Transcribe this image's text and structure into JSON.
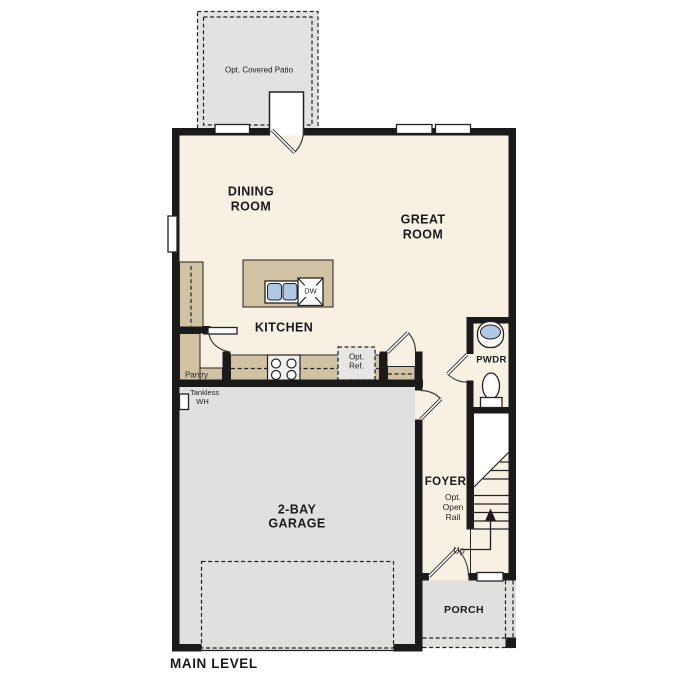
{
  "title": "MAIN LEVEL",
  "colors": {
    "wall": "#1a1a1a",
    "floor": "#f8f0e2",
    "patio": "#e2e2e0",
    "garage": "#e0e0de",
    "counter": "#d2c2a4",
    "sink": "#b0c8e4",
    "optref": "#e6e6e4"
  },
  "rooms": {
    "patio": {
      "label": "Opt. Covered Patio"
    },
    "dining": {
      "label": "DINING\nROOM"
    },
    "great": {
      "label": "GREAT\nROOM"
    },
    "kitchen": {
      "label": "KITCHEN"
    },
    "pantry": {
      "label": "Pantry"
    },
    "pwdr": {
      "label": "PWDR"
    },
    "foyer": {
      "label": "FOYER"
    },
    "garage": {
      "label": "2-BAY\nGARAGE"
    },
    "porch": {
      "label": "PORCH"
    }
  },
  "annotations": {
    "dishwasher": "DW",
    "opt_ref": "Opt.\nRef.",
    "tankless": "Tankless\n   WH",
    "open_rail": "Opt.\nOpen\nRail",
    "up": "Up"
  },
  "footer": {
    "level_label": "MAIN LEVEL"
  }
}
